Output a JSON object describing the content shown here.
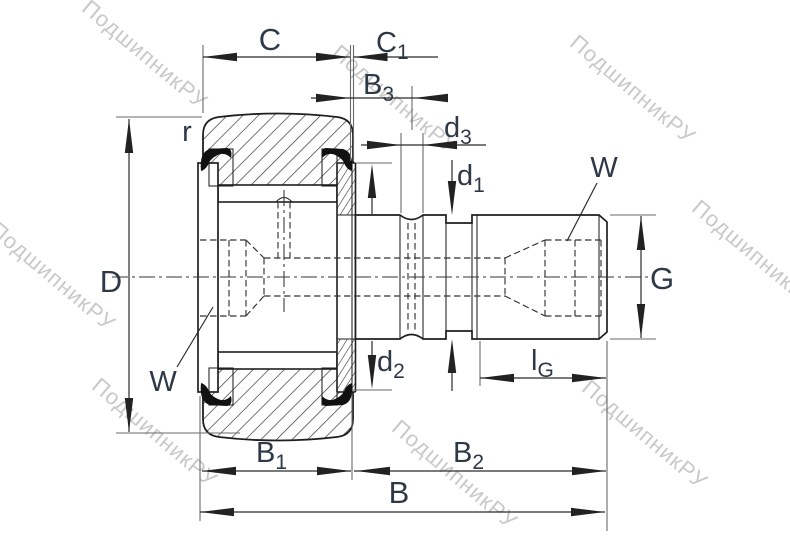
{
  "drawing": {
    "kind": "bearing-cross-section",
    "subject": "stud-type track roller cam follower, dimensioned engineering drawing"
  },
  "labels": {
    "C": {
      "main": "C",
      "sub": ""
    },
    "C1": {
      "main": "C",
      "sub": "1"
    },
    "B3": {
      "main": "B",
      "sub": "3"
    },
    "d3": {
      "main": "d",
      "sub": "3"
    },
    "d1": {
      "main": "d",
      "sub": "1"
    },
    "d2": {
      "main": "d",
      "sub": "2"
    },
    "D": {
      "main": "D",
      "sub": ""
    },
    "r": {
      "main": "r",
      "sub": ""
    },
    "W_left": {
      "main": "W",
      "sub": ""
    },
    "W_right": {
      "main": "W",
      "sub": ""
    },
    "G": {
      "main": "G",
      "sub": ""
    },
    "lG": {
      "main": "l",
      "sub": "G"
    },
    "B1": {
      "main": "B",
      "sub": "1"
    },
    "B2": {
      "main": "B",
      "sub": "2"
    },
    "B": {
      "main": "B",
      "sub": ""
    }
  },
  "watermark": {
    "text": "ПодшипникРУ",
    "color": "#c9c9c9"
  },
  "colors": {
    "line": "#1f1f1f",
    "dimension": "#2b2b2b",
    "extension": "#6a6a6a",
    "label": "#2e3947",
    "watermark": "#c9c9c9",
    "background": "#ffffff"
  }
}
